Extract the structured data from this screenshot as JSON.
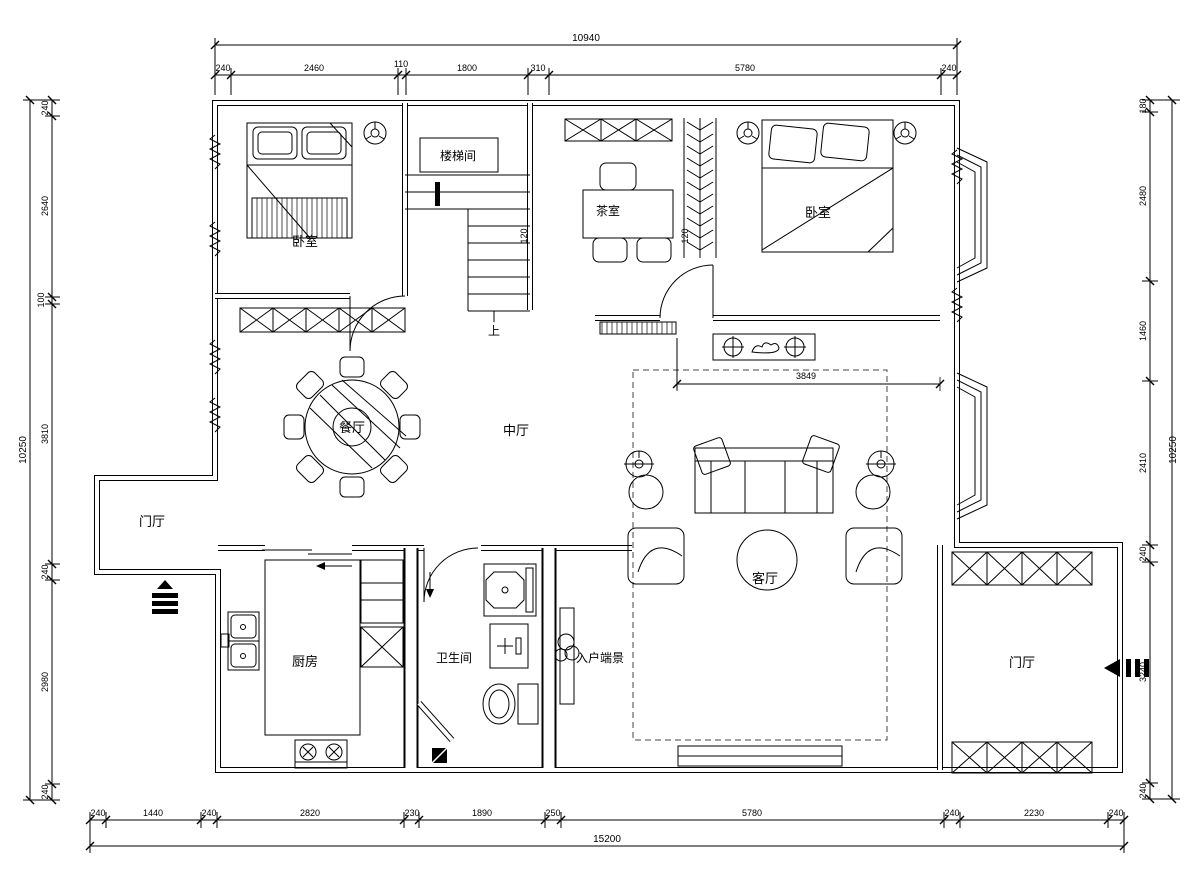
{
  "meta": {
    "drawing_type": "residential floor plan",
    "background_color": "#ffffff",
    "line_color": "#000000"
  },
  "rooms": {
    "bedroom_left": "卧室",
    "stairwell": "楼梯间",
    "tea_room": "茶室",
    "bedroom_right": "卧室",
    "dining": "餐厅",
    "central_hall": "中厅",
    "foyer_left": "门厅",
    "living": "客厅",
    "kitchen": "厨房",
    "bathroom": "卫生间",
    "entry_vista": "入户端景",
    "foyer_right": "门厅",
    "stair_up": "上"
  },
  "dims": {
    "top": {
      "total": "10940",
      "segs": [
        "240",
        "2460",
        "110",
        "1800",
        "310",
        "5780",
        "240"
      ]
    },
    "bottom": {
      "total": "15200",
      "segs": [
        "240",
        "1440",
        "240",
        "2820",
        "230",
        "1890",
        "250",
        "5780",
        "240",
        "2230",
        "240"
      ]
    },
    "left": {
      "total": "10250",
      "segs": [
        "240",
        "2640",
        "100",
        "3810",
        "240",
        "2980",
        "240"
      ]
    },
    "right": {
      "total": "10250",
      "segs": [
        "180",
        "2480",
        "1460",
        "2410",
        "240",
        "3240",
        "240"
      ]
    },
    "interior": {
      "living_width": "3849",
      "wall_a": "120",
      "wall_b": "120"
    }
  }
}
